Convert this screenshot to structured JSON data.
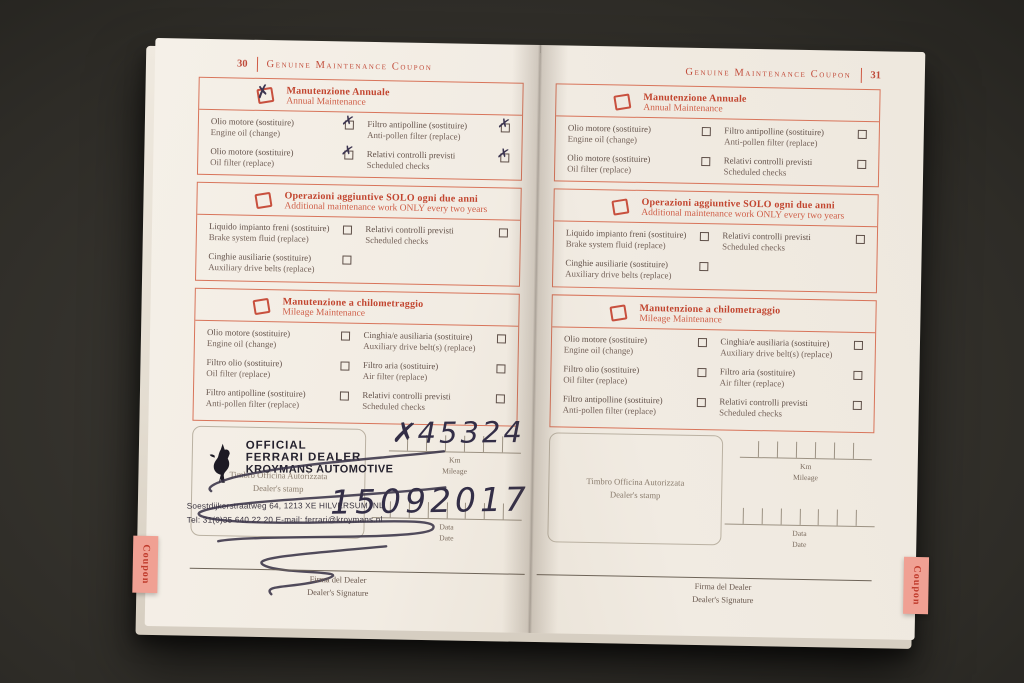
{
  "colors": {
    "accent_red": "#c8503e",
    "page_paper": "#f1ebe2",
    "pen_ink": "#332e47",
    "tab_background": "#f0a093",
    "surface_dark": "#2e2c27"
  },
  "glyphs": {
    "check": "✗"
  },
  "header_title": "Genuine Maintenance Coupon",
  "tab_label": "Coupon",
  "left_page": {
    "number": "30",
    "km_prefix": "✗",
    "km_value": "45324",
    "date_value": "15092017",
    "stamp": {
      "line1": "OFFICIAL",
      "line2": "FERRARI DEALER",
      "line3": "KROYMANS AUTOMOTIVE",
      "address": "Soestdijkerstraatweg 64, 1213 XE HILVERSUM, NL",
      "tel": "Tel: 31(0)35 640 22 20 E-mail: ferrari@kroymans.nl"
    }
  },
  "right_page": {
    "number": "31"
  },
  "sections": {
    "annual": {
      "title_it": "Manutenzione Annuale",
      "title_en": "Annual Maintenance",
      "items": [
        {
          "it": "Olio motore (sostituire)",
          "en": "Engine oil (change)"
        },
        {
          "it": "Filtro antipolline (sostituire)",
          "en": "Anti-pollen filter (replace)"
        },
        {
          "it": "Olio motore (sostituire)",
          "en": "Oil filter (replace)"
        },
        {
          "it": "Relativi controlli previsti",
          "en": "Scheduled checks"
        }
      ]
    },
    "biennial": {
      "title_it": "Operazioni aggiuntive SOLO ogni due anni",
      "title_en": "Additional maintenance work ONLY every two years",
      "items": [
        {
          "it": "Liquido impianto freni (sostituire)",
          "en": "Brake system fluid (replace)"
        },
        {
          "it": "Relativi controlli previsti",
          "en": "Scheduled checks"
        },
        {
          "it": "Cinghie ausiliarie (sostituire)",
          "en": "Auxiliary drive belts (replace)"
        }
      ]
    },
    "mileage": {
      "title_it": "Manutenzione a chilometraggio",
      "title_en": "Mileage Maintenance",
      "items": [
        {
          "it": "Olio motore (sostituire)",
          "en": "Engine oil (change)"
        },
        {
          "it": "Cinghia/e ausiliaria (sostituire)",
          "en": "Auxiliary drive belt(s) (replace)"
        },
        {
          "it": "Filtro olio (sostituire)",
          "en": "Oil filter (replace)"
        },
        {
          "it": "Filtro aria (sostituire)",
          "en": "Air filter (replace)"
        },
        {
          "it": "Filtro antipolline (sostituire)",
          "en": "Anti-pollen filter (replace)"
        },
        {
          "it": "Relativi controlli previsti",
          "en": "Scheduled checks"
        }
      ]
    }
  },
  "stamp_area": {
    "placeholder_it": "Timbro Officina Autorizzata",
    "placeholder_en": "Dealer's stamp",
    "km_it": "Km",
    "km_en": "Mileage",
    "date_it": "Data",
    "date_en": "Date"
  },
  "signature": {
    "it": "Firma del Dealer",
    "en": "Dealer's Signature"
  }
}
